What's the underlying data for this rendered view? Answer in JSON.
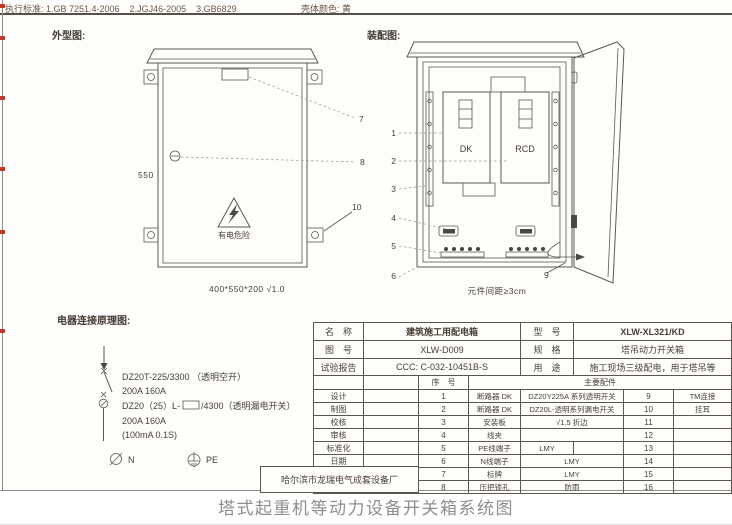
{
  "colors": {
    "drawing_line": "#5b5855",
    "table_border": "#5a554f",
    "topbar_text": "#6e5646",
    "caption_text": "#8e8e8e",
    "edge_mark_red": "#bf3a2b",
    "sheet_bg": "#fdfdfb"
  },
  "topbar": {
    "standards": "执行标准: 1.GB 7251.4-2006    2.JGJ46-2005    3.GB6829",
    "shell_color": "壳体颜色: 黄"
  },
  "outline": {
    "title": "外型图:",
    "height_dim": "550",
    "size_note": "400*550*200  √1.0",
    "warning_text": "有电危险",
    "callouts": [
      "7",
      "8",
      "10"
    ]
  },
  "assembly": {
    "title": "装配图:",
    "dk_label": "DK",
    "rcd_label": "RCD",
    "spacing_note": "元件间距≥3cm",
    "callouts": [
      "1",
      "2",
      "3",
      "4",
      "5",
      "6",
      "9"
    ]
  },
  "schematic": {
    "title": "电器连接原理图:",
    "breaker1_model": "DZ20T-225/3300 （透明空开）",
    "breaker1_rating": "200A  160A",
    "breaker2_model_prefix": "DZ20（25）L-",
    "breaker2_model_suffix": "/4300（透明漏电开关）",
    "breaker2_rating": "200A  160A",
    "breaker2_sensitivity": "(100mA 0.1S)",
    "n_label": "N",
    "pe_label": "PE"
  },
  "titleblock": {
    "name_label": "名　称",
    "name_value": "建筑施工用配电箱",
    "model_label": "型　号",
    "model_value": "XLW-XL321/KD",
    "drawing_label": "图　号",
    "drawing_value": "XLW-D009",
    "spec_label": "规　格",
    "spec_value": "塔吊动力开关箱",
    "report_label": "试验报告",
    "report_value": "CCC: C-032-10451B-S",
    "use_label": "用　途",
    "use_value": "施工现场三级配电，用于塔吊等",
    "seq_label": "序　号",
    "parts_label": "主要配件",
    "sign_rows": [
      "设计",
      "制图",
      "校核",
      "审核",
      "标准化",
      "日期"
    ],
    "parts": [
      {
        "no": "1",
        "name": "断路器 DK",
        "spec": "DZ20Y225A 系列透明开关",
        "no2": "9",
        "extra": "TM连接"
      },
      {
        "no": "2",
        "name": "断路器 DK",
        "spec": "DZ20L-透明系列漏电开关",
        "no2": "10",
        "extra": "挂耳"
      },
      {
        "no": "3",
        "name": "安装板",
        "spec": "√1.5 折边",
        "no2": "11",
        "extra": ""
      },
      {
        "no": "4",
        "name": "线夹",
        "spec": "",
        "no2": "12",
        "extra": ""
      },
      {
        "no": "5",
        "name": "PE线端子",
        "spec": "LMY",
        "no2": "13",
        "extra": ""
      },
      {
        "no": "6",
        "name": "N线端子",
        "spec": "LMY",
        "no2": "14",
        "extra": ""
      },
      {
        "no": "7",
        "name": "标牌",
        "spec": "LMY",
        "no2": "15",
        "extra": ""
      },
      {
        "no": "8",
        "name": "压把锁孔",
        "spec": "防雨",
        "no2": "16",
        "extra": ""
      }
    ],
    "company": "哈尔滨市龙瑞电气成套设备厂"
  },
  "page": {
    "caption": "塔式起重机等动力设备开关箱系统图"
  }
}
